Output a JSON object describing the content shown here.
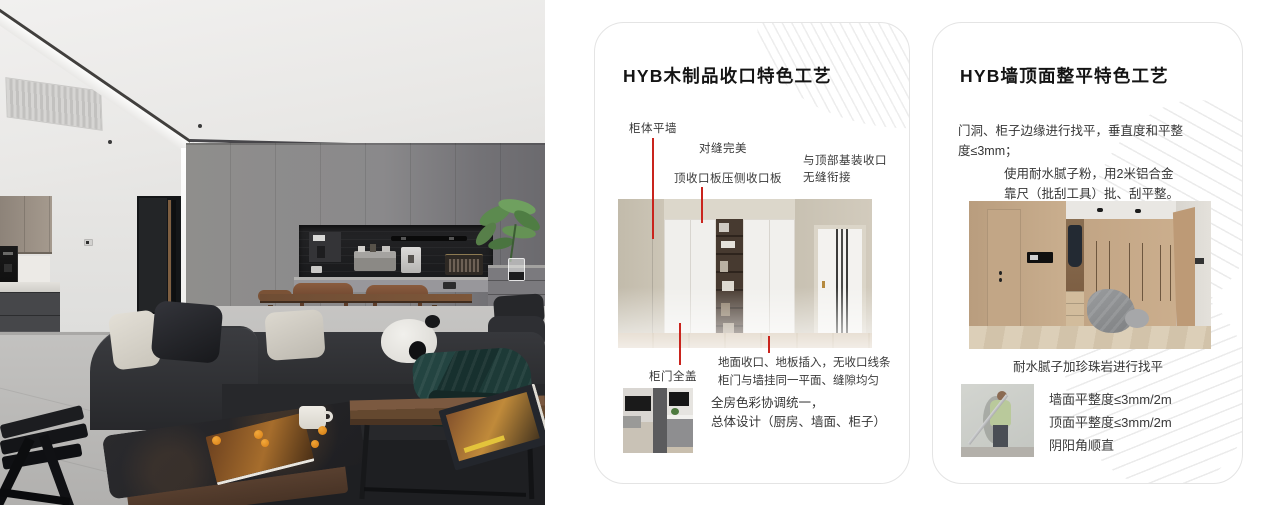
{
  "colors": {
    "leader_line_red": "#c9241d",
    "card_border": "#e4e4e4",
    "title_text": "#141414",
    "body_text": "#3a3a3a"
  },
  "card1": {
    "title": "HYB木制品收口特色工艺",
    "callout_cabinet_wall": "柜体平墙",
    "callout_seam_perfect": "对缝完美",
    "callout_top_trim_panel": "顶收口板压侧收口板",
    "callout_ceiling_joint": "与顶部基装收口\n无缝衔接",
    "callout_full_overlay_door": "柜门全盖",
    "note_floor_joint": "地面收口、地板插入，无收口线条\n柜门与墙挂同一平面、缝隙均匀",
    "note_color_line1": "全房色彩协调统一，",
    "note_color_line2": "总体设计（厨房、墙面、柜子）"
  },
  "card2": {
    "title": "HYB墙顶面整平特色工艺",
    "para_edge_leveling": "门洞、柜子边缘进行找平，垂直度和平整\n度≤3mm；",
    "para_putty": "使用耐水腻子粉，用2米铝合金\n靠尺（批刮工具）批、刮平整。",
    "caption_perlite": "耐水腻子加珍珠岩进行找平",
    "spec_wall_flatness": "墙面平整度≤3mm/2m",
    "spec_ceiling_flatness": "顶面平整度≤3mm/2m",
    "spec_corner_straight": "阴阳角顺直"
  }
}
